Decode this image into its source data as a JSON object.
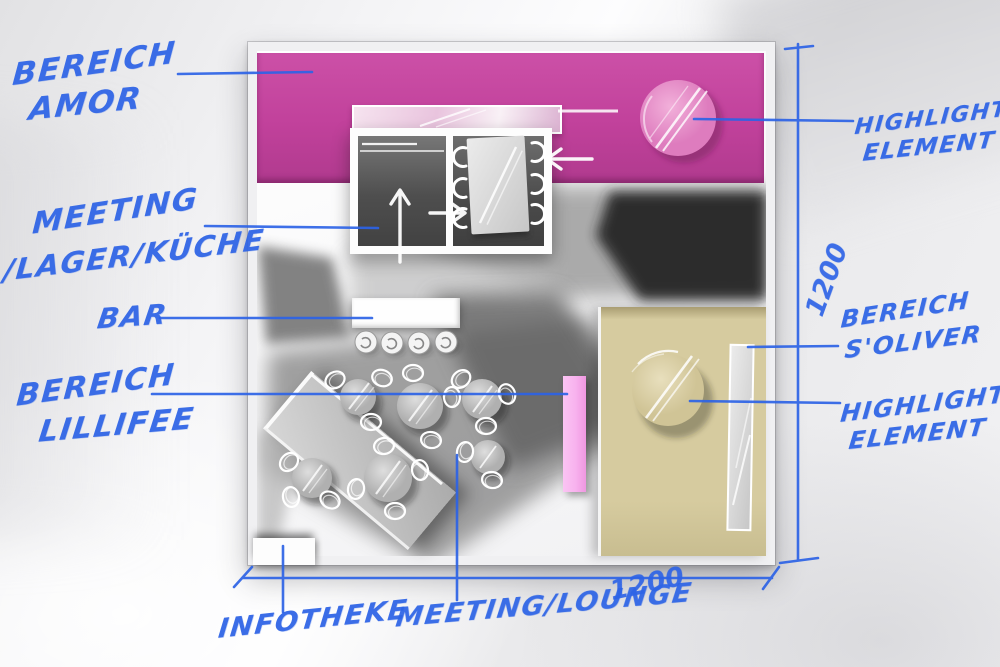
{
  "sketch": {
    "type": "hand-annotated exhibition booth floor plan",
    "labels": {
      "amor": {
        "line1": "BEREICH",
        "line2": "AMOR"
      },
      "meeting_lager": {
        "line1": "MEETING",
        "line2": "/LAGER/KÜCHE"
      },
      "bar": {
        "text": "BAR"
      },
      "lillifee": {
        "line1": "BEREICH",
        "line2": "LILLIFEE"
      },
      "infotheke": {
        "text": "INFOTHEKE"
      },
      "meeting_lounge": {
        "text": "MEETING/LOUNGE"
      },
      "highlight_top": {
        "line1": "HIGHLIGHT",
        "line2": "ELEMENT"
      },
      "soliver": {
        "line1": "BEREICH",
        "line2": "S'OLIVER"
      },
      "highlight_right": {
        "line1": "HIGHLIGHT",
        "line2": "ELEMENT"
      }
    },
    "dimensions": {
      "right": "1200",
      "bottom": "1200"
    },
    "colors": {
      "annotation_ink": "#2d63e6",
      "amor_area_pink": "#c1419b",
      "highlight_circle_pink": "#e591c8",
      "soliver_area_beige": "#d6cb9f",
      "soliver_circle_beige": "#ddd3ab",
      "accent_strip_pink": "#f8b2ee"
    }
  }
}
